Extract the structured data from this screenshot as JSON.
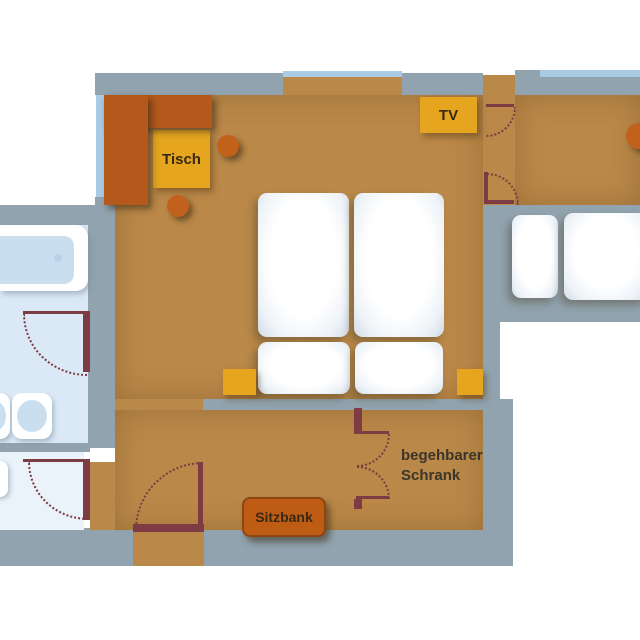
{
  "plan": {
    "labels": {
      "table": "Tisch",
      "tv": "TV",
      "bench": "Sitzbank",
      "walkin_closet": "begehbarer\nSchrank"
    },
    "palette": {
      "floor": "#ba8848",
      "wall": "#91a3ae",
      "window": "#a9cbe4",
      "bath_floor": "#dbe9f6",
      "wc_floor": "#eaf2fa",
      "fixture_blue": "#c9dff0",
      "accent_orange": "#b4591b",
      "accent_yellow": "#e5a51f",
      "door": "#7d3b44",
      "bed_white": "#ffffff",
      "label_text": "#382912"
    }
  }
}
